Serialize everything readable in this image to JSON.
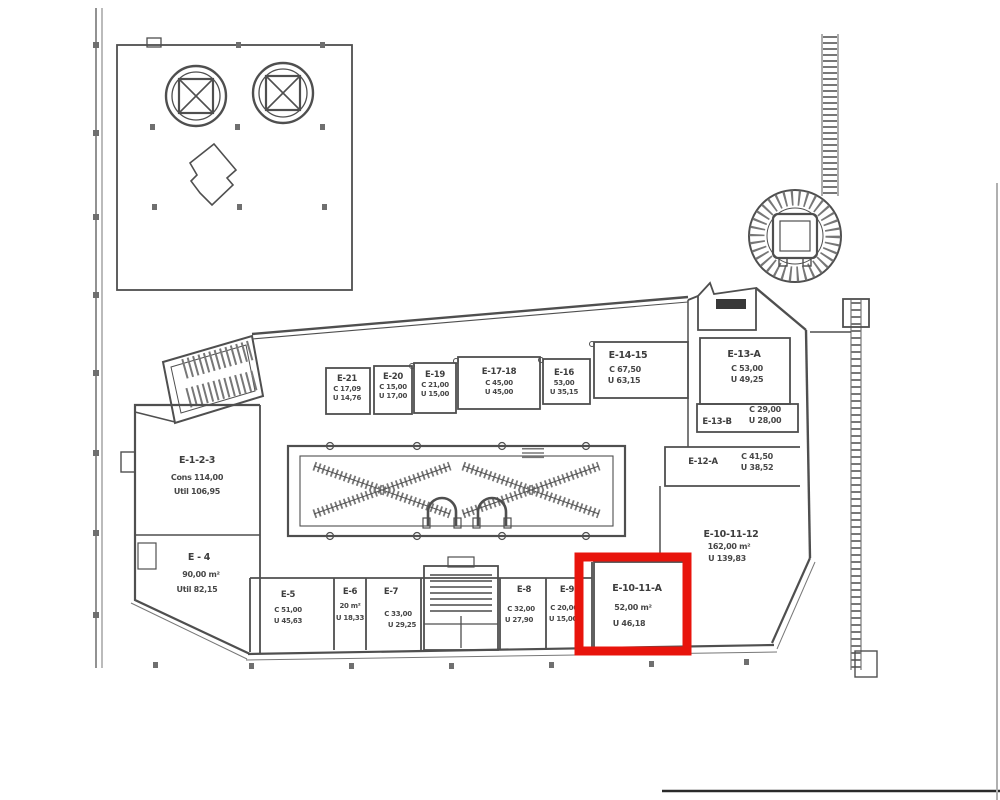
{
  "colors": {
    "ink": "#4f4f4f",
    "highlight": "#e8140c",
    "background": "#ffffff"
  },
  "highlight": {
    "unit": "E-10-11-A"
  },
  "units": [
    {
      "id": "E-21",
      "label": "E-21",
      "line1": "C 17,09",
      "line2": "U 14,76"
    },
    {
      "id": "E-20",
      "label": "E-20",
      "line1": "C 15,00",
      "line2": "U 17,00"
    },
    {
      "id": "E-19",
      "label": "E-19",
      "line1": "C 21,00",
      "line2": "U 15,00"
    },
    {
      "id": "E-17-18",
      "label": "E-17-18",
      "line1": "C 45,00",
      "line2": "U 45,00"
    },
    {
      "id": "E-16",
      "label": "E-16",
      "line1": "53,00",
      "line2": "U 35,15"
    },
    {
      "id": "E-14-15",
      "label": "E-14-15",
      "line1": "C 67,50",
      "line2": "U 63,15"
    },
    {
      "id": "E-13-A",
      "label": "E-13-A",
      "line1": "C 53,00",
      "line2": "U 49,25"
    },
    {
      "id": "E-13-B",
      "label": "E-13-B",
      "line1": "C 29,00",
      "line2": "U 28,00"
    },
    {
      "id": "E-12-A",
      "label": "E-12-A",
      "line1": "C 41,50",
      "line2": "U 38,52"
    },
    {
      "id": "E-10-11-12",
      "label": "E-10-11-12",
      "line1": "162,00 m²",
      "line2": "U 139,83"
    },
    {
      "id": "E-10-11-A",
      "label": "E-10-11-A",
      "line1": "52,00 m²",
      "line2": "U 46,18"
    },
    {
      "id": "E-1-2-3",
      "label": "E-1-2-3",
      "line1": "Cons 114,00",
      "line2": "Util 106,95"
    },
    {
      "id": "E-4",
      "label": "E - 4",
      "line1": "90,00 m²",
      "line2": "Util 82,15"
    },
    {
      "id": "E-5",
      "label": "E-5",
      "line1": "C 51,00",
      "line2": "U 45,63"
    },
    {
      "id": "E-6",
      "label": "E-6",
      "line1": "20 m²",
      "line2": "U 18,33"
    },
    {
      "id": "E-7",
      "label": "E-7",
      "line1": "C 33,00",
      "line2": "U 29,25"
    },
    {
      "id": "E-8",
      "label": "E-8",
      "line1": "C 32,00",
      "line2": "U 27,90"
    },
    {
      "id": "E-9",
      "label": "E-9",
      "line1": "C 20,00",
      "line2": "U 15,00"
    }
  ]
}
